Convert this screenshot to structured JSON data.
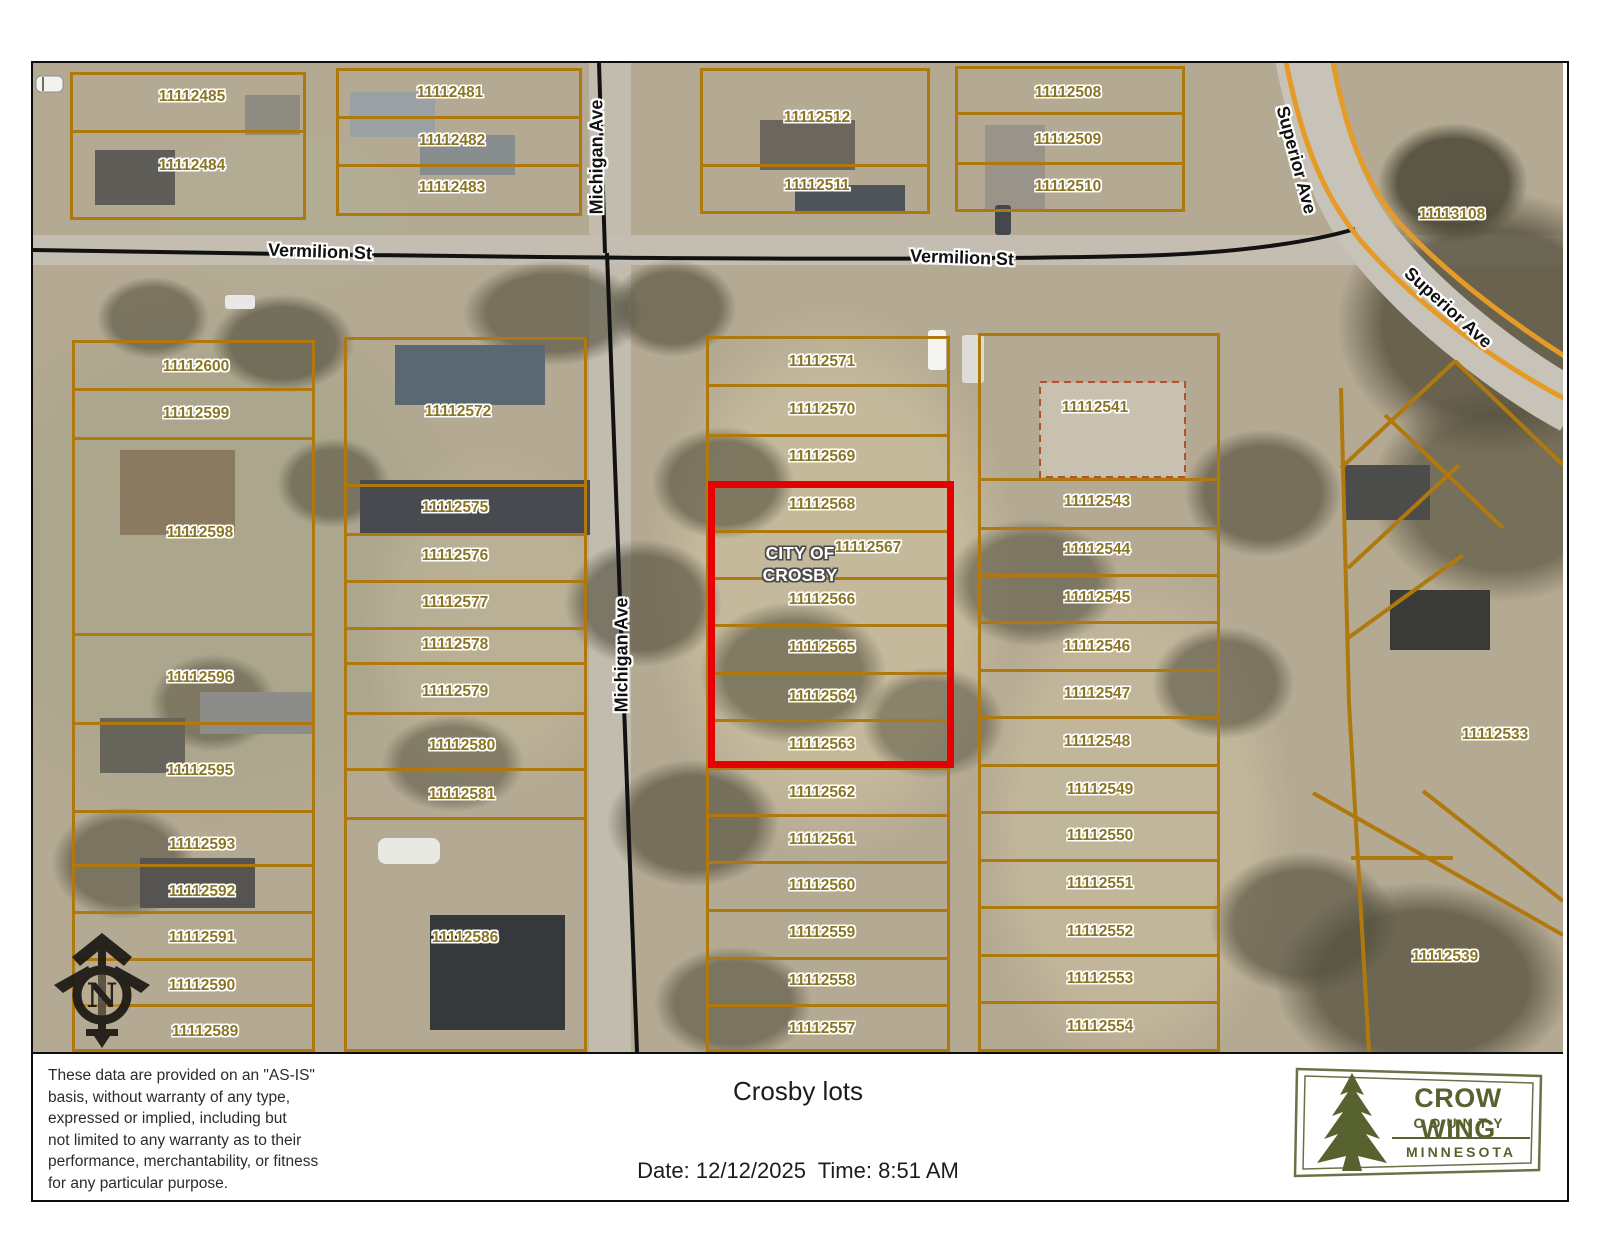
{
  "map": {
    "origin": {
      "x": 33,
      "y": 63,
      "width": 1530,
      "height": 989
    },
    "colors": {
      "parcel_line": "#b0790e",
      "highlight": "#e60000",
      "parcel_label": "#8a7525",
      "street_label": "#111111",
      "logo_green": "#57622f"
    },
    "city_label": "CITY OF\nCROSBY",
    "north_label": "N",
    "street_labels": [
      {
        "name": "Vermilion St",
        "x": 320,
        "y": 252,
        "rot": 2
      },
      {
        "name": "Vermilion St",
        "x": 962,
        "y": 258,
        "rot": 2
      },
      {
        "name": "Michigan Ave",
        "x": 597,
        "y": 157,
        "rot": -90
      },
      {
        "name": "Michigan Ave",
        "x": 622,
        "y": 655,
        "rot": -90
      },
      {
        "name": "Superior Ave",
        "x": 1296,
        "y": 160,
        "rot": 75
      },
      {
        "name": "Superior Ave",
        "x": 1448,
        "y": 308,
        "rot": 42
      }
    ],
    "highlight_box": {
      "x": 708,
      "y": 481,
      "w": 246,
      "h": 287
    },
    "blocks": [
      {
        "x": 70,
        "y": 72,
        "w": 236,
        "h": 148,
        "dividers": [
          130
        ]
      },
      {
        "x": 336,
        "y": 68,
        "w": 246,
        "h": 148,
        "dividers": [
          116,
          164
        ]
      },
      {
        "x": 700,
        "y": 68,
        "w": 230,
        "h": 146,
        "dividers": [
          164
        ]
      },
      {
        "x": 955,
        "y": 66,
        "w": 230,
        "h": 146,
        "dividers": [
          112,
          162
        ]
      },
      {
        "x": 72,
        "y": 340,
        "w": 243,
        "h": 712,
        "dividers": [
          388,
          437,
          633,
          722,
          810,
          864,
          911,
          958,
          1004
        ]
      },
      {
        "x": 344,
        "y": 337,
        "w": 243,
        "h": 715,
        "dividers": [
          484,
          533,
          580,
          627,
          662,
          712,
          768,
          817
        ]
      },
      {
        "x": 706,
        "y": 336,
        "w": 244,
        "h": 716,
        "dividers": [
          384,
          434,
          481,
          530,
          577,
          624,
          672,
          719,
          767,
          814,
          861,
          909,
          957,
          1004
        ]
      },
      {
        "x": 978,
        "y": 333,
        "w": 242,
        "h": 719,
        "dividers": [
          478,
          527,
          574,
          621,
          669,
          716,
          764,
          811,
          859,
          906,
          954,
          1001
        ]
      }
    ],
    "parcels": [
      {
        "id": "11112485",
        "x": 192,
        "y": 97
      },
      {
        "id": "11112484",
        "x": 192,
        "y": 166
      },
      {
        "id": "11112481",
        "x": 450,
        "y": 93
      },
      {
        "id": "11112482",
        "x": 452,
        "y": 141
      },
      {
        "id": "11112483",
        "x": 452,
        "y": 188
      },
      {
        "id": "11112512",
        "x": 817,
        "y": 118
      },
      {
        "id": "11112511",
        "x": 817,
        "y": 186
      },
      {
        "id": "11112508",
        "x": 1068,
        "y": 93
      },
      {
        "id": "11112509",
        "x": 1068,
        "y": 140
      },
      {
        "id": "11112510",
        "x": 1068,
        "y": 187
      },
      {
        "id": "11112600",
        "x": 196,
        "y": 367
      },
      {
        "id": "11112599",
        "x": 196,
        "y": 414
      },
      {
        "id": "11112598",
        "x": 200,
        "y": 533
      },
      {
        "id": "11112596",
        "x": 200,
        "y": 678
      },
      {
        "id": "11112595",
        "x": 200,
        "y": 771
      },
      {
        "id": "11112593",
        "x": 202,
        "y": 845
      },
      {
        "id": "11112592",
        "x": 202,
        "y": 892
      },
      {
        "id": "11112591",
        "x": 202,
        "y": 938
      },
      {
        "id": "11112590",
        "x": 202,
        "y": 986
      },
      {
        "id": "11112589",
        "x": 205,
        "y": 1032
      },
      {
        "id": "11112572",
        "x": 458,
        "y": 412
      },
      {
        "id": "11112575",
        "x": 455,
        "y": 508
      },
      {
        "id": "11112576",
        "x": 455,
        "y": 556
      },
      {
        "id": "11112577",
        "x": 455,
        "y": 603
      },
      {
        "id": "11112578",
        "x": 455,
        "y": 645
      },
      {
        "id": "11112579",
        "x": 455,
        "y": 692
      },
      {
        "id": "11112580",
        "x": 462,
        "y": 746
      },
      {
        "id": "11112581",
        "x": 462,
        "y": 795
      },
      {
        "id": "11112586",
        "x": 465,
        "y": 938
      },
      {
        "id": "11112571",
        "x": 822,
        "y": 362
      },
      {
        "id": "11112570",
        "x": 822,
        "y": 410
      },
      {
        "id": "11112569",
        "x": 822,
        "y": 457
      },
      {
        "id": "11112568",
        "x": 822,
        "y": 505
      },
      {
        "id": "11112567",
        "x": 868,
        "y": 548
      },
      {
        "id": "11112566",
        "x": 822,
        "y": 600
      },
      {
        "id": "11112565",
        "x": 822,
        "y": 648
      },
      {
        "id": "11112564",
        "x": 822,
        "y": 697
      },
      {
        "id": "11112563",
        "x": 822,
        "y": 745
      },
      {
        "id": "11112562",
        "x": 822,
        "y": 793
      },
      {
        "id": "11112561",
        "x": 822,
        "y": 840
      },
      {
        "id": "11112560",
        "x": 822,
        "y": 886
      },
      {
        "id": "11112559",
        "x": 822,
        "y": 933
      },
      {
        "id": "11112558",
        "x": 822,
        "y": 981
      },
      {
        "id": "11112557",
        "x": 822,
        "y": 1029
      },
      {
        "id": "11112541",
        "x": 1095,
        "y": 408
      },
      {
        "id": "11112543",
        "x": 1097,
        "y": 502
      },
      {
        "id": "11112544",
        "x": 1097,
        "y": 550
      },
      {
        "id": "11112545",
        "x": 1097,
        "y": 598
      },
      {
        "id": "11112546",
        "x": 1097,
        "y": 647
      },
      {
        "id": "11112547",
        "x": 1097,
        "y": 694
      },
      {
        "id": "11112548",
        "x": 1097,
        "y": 742
      },
      {
        "id": "11112549",
        "x": 1100,
        "y": 790
      },
      {
        "id": "11112550",
        "x": 1100,
        "y": 836
      },
      {
        "id": "11112551",
        "x": 1100,
        "y": 884
      },
      {
        "id": "11112552",
        "x": 1100,
        "y": 932
      },
      {
        "id": "11112553",
        "x": 1100,
        "y": 979
      },
      {
        "id": "11112554",
        "x": 1100,
        "y": 1027
      },
      {
        "id": "11113108",
        "x": 1452,
        "y": 215
      },
      {
        "id": "11112533",
        "x": 1495,
        "y": 735
      },
      {
        "id": "11112539",
        "x": 1445,
        "y": 957
      }
    ]
  },
  "footer": {
    "title": "Crosby lots",
    "date_time": "Date: 12/12/2025  Time: 8:51 AM",
    "disclaimer": "These data are provided on an \"AS-IS\"\nbasis, without warranty of any type,\nexpressed or implied, including but\nnot limited to any warranty as to their\nperformance, merchantability, or fitness\nfor any particular purpose.",
    "logo": {
      "line1": "CROW WING",
      "line2": "COUNTY",
      "line3": "MINNESOTA"
    }
  }
}
